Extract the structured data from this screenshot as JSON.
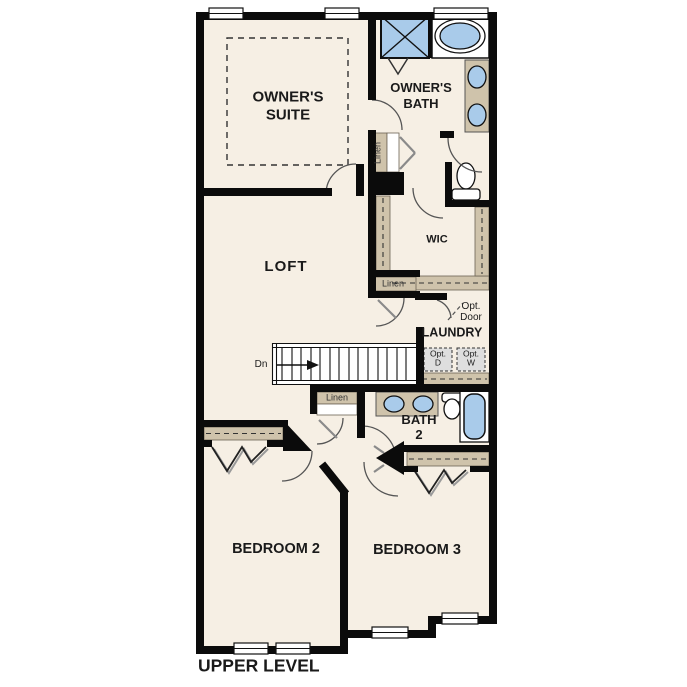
{
  "colors": {
    "floor": "#f6efe4",
    "wall": "#0b0b0b",
    "shelf_tan": "#cfc3ab",
    "fixture_blue": "#a9cbea",
    "optional_gray": "#dedede"
  },
  "rooms": {
    "owners_suite": {
      "line1": "OWNER'S",
      "line2": "SUITE"
    },
    "owners_bath": {
      "line1": "OWNER'S",
      "line2": "BATH"
    },
    "loft": {
      "label": "LOFT"
    },
    "wic": {
      "label": "WIC"
    },
    "laundry": {
      "label": "LAUNDRY"
    },
    "bath_2": {
      "line1": "BATH",
      "line2": "2"
    },
    "bedroom_2": {
      "label": "BEDROOM 2"
    },
    "bedroom_3": {
      "label": "BEDROOM 3"
    }
  },
  "closets": {
    "linen_owners": {
      "label": "Linen"
    },
    "linen_wic": {
      "label": "Linen"
    },
    "linen_hall": {
      "label": "Linen"
    }
  },
  "stairs": {
    "down_label": "Dn"
  },
  "options": {
    "door": {
      "line1": "Opt.",
      "line2": "Door"
    },
    "dryer": {
      "line1": "Opt.",
      "line2": "D"
    },
    "washer": {
      "line1": "Opt.",
      "line2": "W"
    }
  },
  "footer": {
    "level_label": "UPPER LEVEL"
  }
}
